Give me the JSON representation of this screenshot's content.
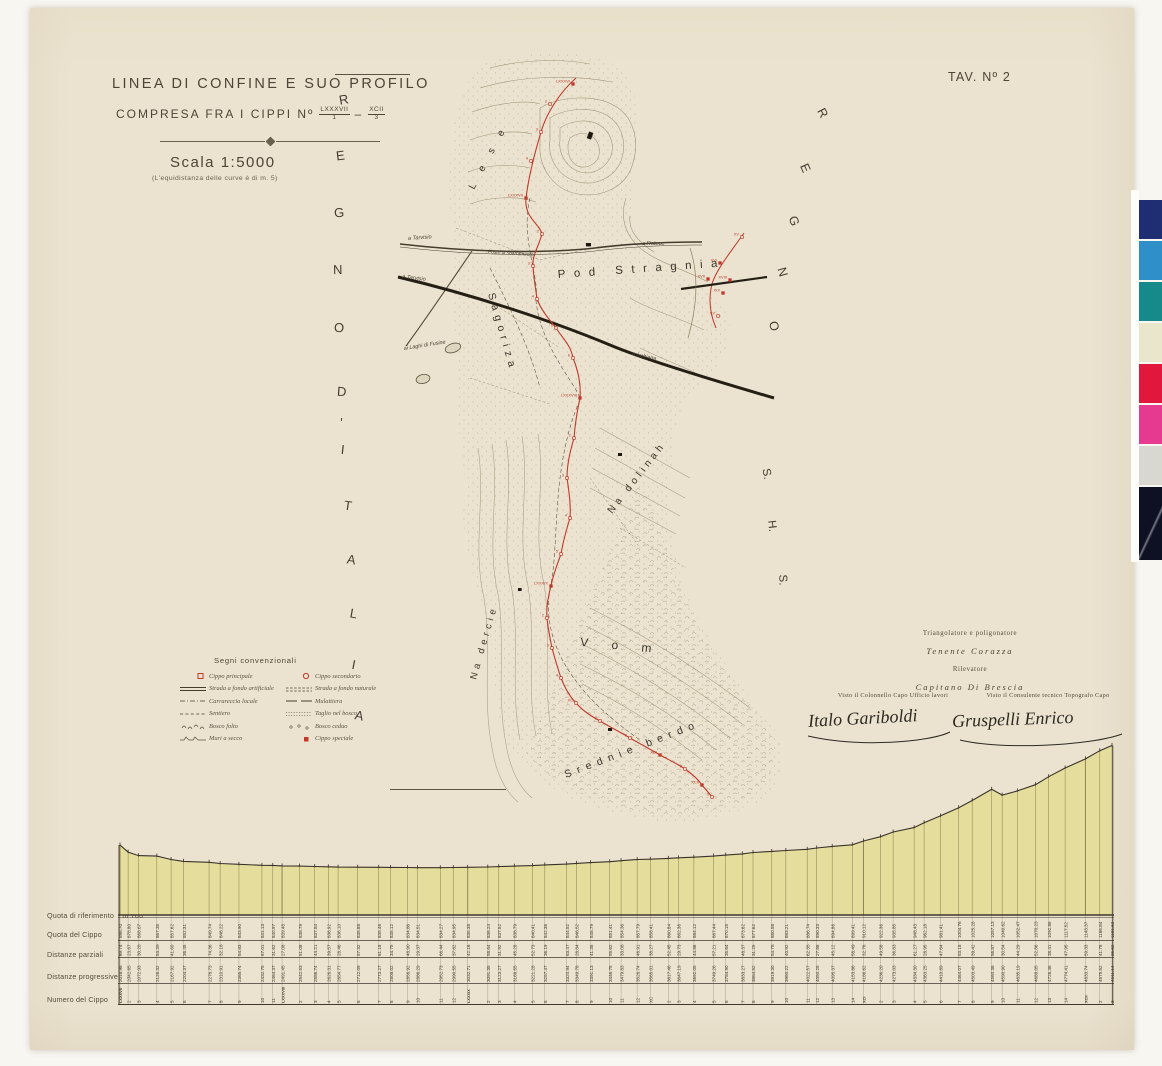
{
  "colors": {
    "paper": "#ebe3d0",
    "ink": "#4a4134",
    "boundary_red": "#c0392b",
    "profile_fill": "#e5dd9b",
    "contour": "#8d7c5e"
  },
  "meta": {
    "sheet_label": "TAV. Nº 2"
  },
  "title_block": {
    "line1": "LINEA DI CONFINE E SUO PROFILO",
    "line2_prefix": "COMPRESA FRA I CIPPI Nº",
    "range_sep": "–",
    "range": {
      "from_num": "LXXXVII",
      "from_den": "1",
      "to_num": "XCII",
      "to_den": "3"
    },
    "scale": "Scala 1:5000",
    "equidistance_note": "(L'equidistanza delle curve è di m. 5)"
  },
  "territories": {
    "left_letters": [
      "R",
      "E",
      "G",
      "N",
      "O",
      "D",
      "'",
      "I",
      "T",
      "A",
      "L",
      "I",
      "A"
    ],
    "right_letters": [
      "R",
      "E",
      "G",
      "N",
      "O"
    ],
    "shs_letters": [
      "S.",
      "H.",
      "S."
    ]
  },
  "legend": {
    "title": "Segni convenzionali",
    "items_left": [
      {
        "icon": "cippo-principale-icon",
        "label": "Cippo principale"
      },
      {
        "icon": "strada-artificiale-icon",
        "label": "Strada a fondo artificiale"
      },
      {
        "icon": "carrareccia-icon",
        "label": "Carrareccia locale"
      },
      {
        "icon": "sentiero-icon",
        "label": "Sentiero"
      },
      {
        "icon": "bosco-folto-icon",
        "label": "Bosco folto"
      },
      {
        "icon": "muri-a-secco-icon",
        "label": "Muri a secco"
      }
    ],
    "items_right": [
      {
        "icon": "cippo-secondario-icon",
        "label": "Cippo secondario"
      },
      {
        "icon": "strada-naturale-icon",
        "label": "Strada a fondo naturale"
      },
      {
        "icon": "mulattiera-icon",
        "label": "Mulattiera"
      },
      {
        "icon": "taglio-bosco-icon",
        "label": "Taglio nel bosco"
      },
      {
        "icon": "bosco-ceduo-icon",
        "label": "Bosco ceduo"
      },
      {
        "icon": "cippo-speciale-icon",
        "label": "Cippo speciale"
      }
    ]
  },
  "map": {
    "toponyms": {
      "lese": "L e s e",
      "pod_stragnia": "Pod Stragnia",
      "sagoriza": "Sagoriza",
      "na_dolinah": "Na dolinah",
      "na_dercie": "Na dercie",
      "vom": "V o m",
      "srednie_berdo": "Srednie berdo"
    },
    "route_labels": {
      "a_tarvisio_road": "a Tarvisio",
      "a_tarvisio_rail": "a Tarvisio",
      "ai_laghi": "ai Laghi di Fusine",
      "a_ratece": "a Ratece",
      "a_lubiana": "a Lubiana",
      "posto": "Posto di sbarramento"
    },
    "boundary_markers_main": [
      {
        "x": 183,
        "y": 36,
        "t": "LXXXVI"
      },
      {
        "x": 160,
        "y": 56,
        "t": "2"
      },
      {
        "x": 151,
        "y": 84,
        "t": "3"
      },
      {
        "x": 141,
        "y": 113,
        "t": "4"
      },
      {
        "x": 136,
        "y": 150,
        "t": "LXXXVII"
      },
      {
        "x": 152,
        "y": 186,
        "t": "2"
      },
      {
        "x": 143,
        "y": 218,
        "t": "3"
      },
      {
        "x": 147,
        "y": 251,
        "t": "4"
      },
      {
        "x": 166,
        "y": 280,
        "t": "5"
      },
      {
        "x": 183,
        "y": 310,
        "t": "6"
      },
      {
        "x": 190,
        "y": 350,
        "t": "LXXXVIII"
      },
      {
        "x": 184,
        "y": 390,
        "t": "2"
      },
      {
        "x": 177,
        "y": 430,
        "t": "3"
      },
      {
        "x": 180,
        "y": 470,
        "t": "4"
      },
      {
        "x": 171,
        "y": 506,
        "t": "5"
      },
      {
        "x": 161,
        "y": 538,
        "t": "LXXXIX"
      },
      {
        "x": 157,
        "y": 570,
        "t": "2"
      },
      {
        "x": 162,
        "y": 600,
        "t": "3"
      },
      {
        "x": 171,
        "y": 630,
        "t": "4"
      },
      {
        "x": 186,
        "y": 655,
        "t": "XC"
      },
      {
        "x": 210,
        "y": 673,
        "t": "2"
      },
      {
        "x": 240,
        "y": 690,
        "t": "3"
      },
      {
        "x": 270,
        "y": 707,
        "t": "XCI"
      },
      {
        "x": 295,
        "y": 721,
        "t": "2"
      },
      {
        "x": 312,
        "y": 737,
        "t": "XCII"
      },
      {
        "x": 322,
        "y": 749,
        "t": "3"
      }
    ],
    "boundary_markers_detail": [
      {
        "x": 352,
        "y": 189,
        "t": "XV"
      },
      {
        "x": 330,
        "y": 215,
        "t": "XVI"
      },
      {
        "x": 318,
        "y": 231,
        "t": "XVII"
      },
      {
        "x": 340,
        "y": 232,
        "t": "XVIII"
      },
      {
        "x": 333,
        "y": 245,
        "t": "XIX"
      },
      {
        "x": 328,
        "y": 268,
        "t": "XX"
      }
    ]
  },
  "credits": {
    "role1": "Triangolatore e poligonatore",
    "name1": "Tenente Corazza",
    "role2": "Rilevatore",
    "name2": "Capitano Di Brescia",
    "visto_left": "Visto il Colonnello Capo Ufficio lavori",
    "sig_left": "Italo Gariboldi",
    "visto_right": "Visto il Consulente tecnico Topografo Capo",
    "sig_right": "Gruspelli Enrico"
  },
  "profile": {
    "row_labels": {
      "reference": "Quota di riferimento",
      "reference_value": "m 700",
      "quota": "Quota del Cippo",
      "parziali": "Distanze parziali",
      "progressive": "Distanze progressive",
      "numero": "Numero del Cippo",
      "dot": "·"
    },
    "columns": [
      {
        "n": "LXXXVII",
        "p": "89.74",
        "q": 898.7,
        "d": 2018.98
      },
      {
        "n": "2",
        "p": "23.67",
        "q": 878.8,
        "d": 2042.65
      },
      {
        "n": "3",
        "p": "30.28",
        "q": 868.67,
        "d": 2072.93
      },
      {
        "n": "4",
        "p": "53.39",
        "q": 867.35,
        "d": 2126.32
      },
      {
        "n": "5",
        "p": "41.60",
        "q": 857.62,
        "d": 2167.92
      },
      {
        "n": "6",
        "p": "36.45",
        "q": 852.31,
        "d": 2204.37
      },
      {
        "n": "7",
        "p": "74.36",
        "q": 849.74,
        "d": 2278.73
      },
      {
        "n": "8",
        "p": "32.18",
        "q": 846.22,
        "d": 2310.91
      },
      {
        "n": "9",
        "p": "54.83",
        "q": 843.9,
        "d": 2365.74
      },
      {
        "n": "10",
        "p": "67.01",
        "q": 841.13,
        "d": 2432.75
      },
      {
        "n": "11",
        "p": "31.62",
        "q": 840.97,
        "d": 2464.37
      },
      {
        "n": "LXXXVIII",
        "p": "27.08",
        "q": 839.48,
        "d": 2491.45
      },
      {
        "n": "2",
        "p": "51.08",
        "q": 838.79,
        "d": 2542.53
      },
      {
        "n": "3",
        "p": "44.21",
        "q": 837.84,
        "d": 2586.74
      },
      {
        "n": "4",
        "p": "39.57",
        "q": 836.92,
        "d": 2626.31
      },
      {
        "n": "5",
        "p": "28.46",
        "q": 836.1,
        "d": 2654.77
      },
      {
        "n": "6",
        "p": "57.32",
        "q": 835.88,
        "d": 2712.09
      },
      {
        "n": "7",
        "p": "61.18",
        "q": 835.46,
        "d": 2773.27
      },
      {
        "n": "8",
        "p": "34.75",
        "q": 835.12,
        "d": 2808.02
      },
      {
        "n": "9",
        "p": "48.90",
        "q": 834.86,
        "d": 2856.92
      },
      {
        "n": "10",
        "p": "29.37",
        "q": 834.51,
        "d": 2886.29
      },
      {
        "n": "11",
        "p": "66.44",
        "q": 834.27,
        "d": 2952.73
      },
      {
        "n": "12",
        "p": "37.82",
        "q": 834.95,
        "d": 2990.55
      },
      {
        "n": "LXXXIX",
        "p": "42.16",
        "q": 835.38,
        "d": 3032.71
      },
      {
        "n": "2",
        "p": "58.64",
        "q": 836.24,
        "d": 3091.35
      },
      {
        "n": "3",
        "p": "31.92",
        "q": 837.52,
        "d": 3123.27
      },
      {
        "n": "4",
        "p": "45.28",
        "q": 838.79,
        "d": 3168.55
      },
      {
        "n": "5",
        "p": "52.73",
        "q": 840.41,
        "d": 3221.28
      },
      {
        "n": "6",
        "p": "36.19",
        "q": 842.36,
        "d": 3257.47
      },
      {
        "n": "7",
        "p": "63.47",
        "q": 844.52,
        "d": 3320.94
      },
      {
        "n": "8",
        "p": "28.84",
        "q": 846.52,
        "d": 3349.78
      },
      {
        "n": "9",
        "p": "41.35",
        "q": 848.79,
        "d": 3391.13
      },
      {
        "n": "10",
        "p": "55.62",
        "q": 851.41,
        "d": 3446.75
      },
      {
        "n": "11",
        "p": "33.08",
        "q": 854.36,
        "d": 3479.83
      },
      {
        "n": "12",
        "p": "46.91",
        "q": 857.79,
        "d": 3526.74
      },
      {
        "n": "XC",
        "p": "38.27",
        "q": 858.41,
        "d": 3565.01
      },
      {
        "n": "2",
        "p": "52.45",
        "q": 860.84,
        "d": 3617.46
      },
      {
        "n": "3",
        "p": "29.73",
        "q": 862.36,
        "d": 3647.19
      },
      {
        "n": "4",
        "p": "44.86",
        "q": 864.12,
        "d": 3692.05
      },
      {
        "n": "5",
        "p": "57.21",
        "q": 867.44,
        "d": 3749.26
      },
      {
        "n": "6",
        "p": "35.64",
        "q": 870.15,
        "d": 3784.9
      },
      {
        "n": "7",
        "p": "48.37",
        "q": 873.62,
        "d": 3833.27
      },
      {
        "n": "8",
        "p": "31.25",
        "q": 877.62,
        "d": 3864.52
      },
      {
        "n": "9",
        "p": "54.78",
        "q": 880.58,
        "d": 3919.3
      },
      {
        "n": "10",
        "p": "40.92",
        "q": 883.21,
        "d": 3960.22
      },
      {
        "n": "11",
        "p": "62.35",
        "q": 886.74,
        "d": 4022.57
      },
      {
        "n": "12",
        "p": "27.68",
        "q": 890.33,
        "d": 4050.25
      },
      {
        "n": "13",
        "p": "45.12",
        "q": 894.86,
        "d": 4095.37
      },
      {
        "n": "14",
        "p": "58.49",
        "q": 899.41,
        "d": 4153.86
      },
      {
        "n": "XCI",
        "p": "32.76",
        "q": 910.12,
        "d": 4186.62
      },
      {
        "n": "2",
        "p": "49.58",
        "q": 922.36,
        "d": 4236.2
      },
      {
        "n": "3",
        "p": "36.83",
        "q": 935.85,
        "d": 4273.03
      },
      {
        "n": "4",
        "p": "61.27",
        "q": 948.43,
        "d": 4334.3
      },
      {
        "n": "5",
        "p": "28.95",
        "q": 962.18,
        "d": 4363.25
      },
      {
        "n": "6",
        "p": "47.64",
        "q": 981.41,
        "d": 4410.89
      },
      {
        "n": "7",
        "p": "53.18",
        "q": 1004.76,
        "d": 4464.07
      },
      {
        "n": "8",
        "p": "39.42",
        "q": 1025.28,
        "d": 4503.49
      },
      {
        "n": "9",
        "p": "56.87",
        "q": 1057.13,
        "d": 4560.36
      },
      {
        "n": "10",
        "p": "30.54",
        "q": 1040.62,
        "d": 4590.9
      },
      {
        "n": "11",
        "p": "44.29",
        "q": 1052.47,
        "d": 4635.19
      },
      {
        "n": "12",
        "p": "52.86",
        "q": 1070.23,
        "d": 4688.05
      },
      {
        "n": "13",
        "p": "38.41",
        "q": 1092.86,
        "d": 4726.46
      },
      {
        "n": "14",
        "p": "47.95",
        "q": 1117.52,
        "d": 4774.41
      },
      {
        "n": "XCII",
        "p": "59.33",
        "q": 1143.37,
        "d": 4833.74
      },
      {
        "n": "2",
        "p": "41.78",
        "q": 1166.84,
        "d": 4875.52
      },
      {
        "n": "3",
        "p": "35.62",
        "q": 1181.62,
        "d": 4911.14
      }
    ]
  },
  "chart_data": {
    "type": "area",
    "title": "Profilo altimetrico della linea di confine",
    "xlabel": "Distanza progressiva (m)",
    "ylabel": "Quota del cippo (m)",
    "baseline_m": 700,
    "x": [
      2018.98,
      2042.65,
      2072.93,
      2126.32,
      2167.92,
      2204.37,
      2278.73,
      2310.91,
      2365.74,
      2432.75,
      2464.37,
      2491.45,
      2542.53,
      2586.74,
      2626.31,
      2654.77,
      2712.09,
      2773.27,
      2808.02,
      2856.92,
      2886.29,
      2952.73,
      2990.55,
      3032.71,
      3091.35,
      3123.27,
      3168.55,
      3221.28,
      3257.47,
      3320.94,
      3349.78,
      3391.13,
      3446.75,
      3479.83,
      3526.74,
      3565.01,
      3617.46,
      3647.19,
      3692.05,
      3749.26,
      3784.9,
      3833.27,
      3864.52,
      3919.3,
      3960.22,
      4022.57,
      4050.25,
      4095.37,
      4153.86,
      4186.62,
      4236.2,
      4273.03,
      4334.3,
      4363.25,
      4410.89,
      4464.07,
      4503.49,
      4560.36,
      4590.9,
      4635.19,
      4688.05,
      4726.46,
      4774.41,
      4833.74,
      4875.52,
      4911.14
    ],
    "y": [
      898.7,
      878.8,
      868.67,
      867.35,
      857.62,
      852.31,
      849.74,
      846.22,
      843.9,
      841.13,
      840.97,
      839.48,
      838.79,
      837.84,
      836.92,
      836.1,
      835.88,
      835.46,
      835.12,
      834.86,
      834.51,
      834.27,
      834.95,
      835.38,
      836.24,
      837.52,
      838.79,
      840.41,
      842.36,
      844.52,
      846.52,
      848.79,
      851.41,
      854.36,
      857.79,
      858.41,
      860.84,
      862.36,
      864.12,
      867.44,
      870.15,
      873.62,
      877.62,
      880.58,
      883.21,
      886.74,
      890.33,
      894.86,
      899.41,
      910.12,
      922.36,
      935.85,
      948.43,
      962.18,
      981.41,
      1004.76,
      1025.28,
      1057.13,
      1040.62,
      1052.47,
      1070.23,
      1092.86,
      1117.52,
      1143.37,
      1166.84,
      1181.62
    ]
  },
  "calibration_bar": [
    "#1f2d73",
    "#2f8fc9",
    "#16898b",
    "#eae6cb",
    "#e2173d",
    "#e63a90",
    "#d8d7d0",
    "#0e1124"
  ]
}
